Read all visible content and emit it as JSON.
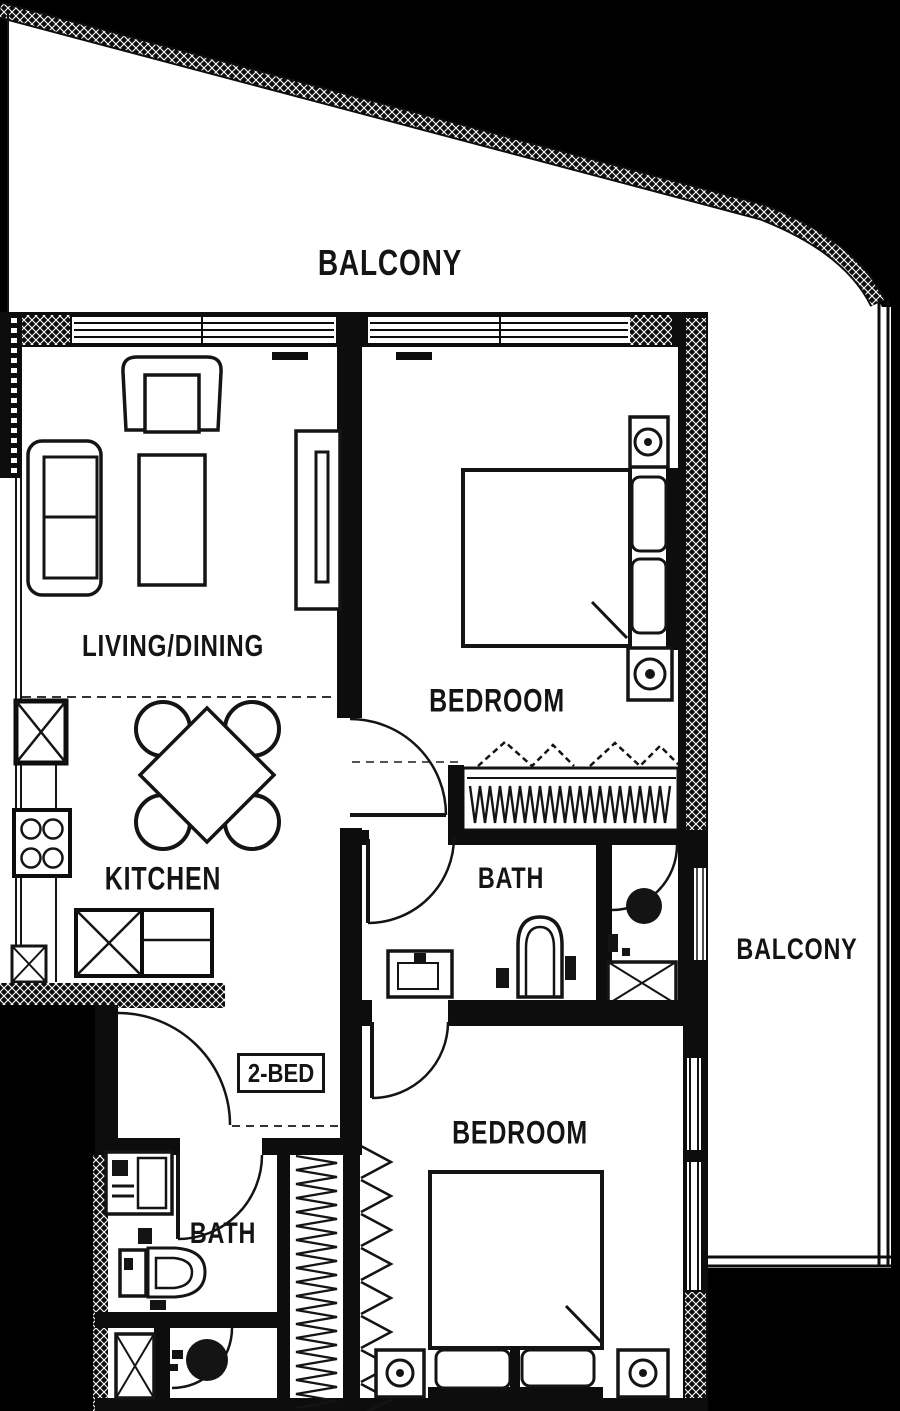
{
  "plan": {
    "unit_label": "2-BED",
    "labels": {
      "balcony_top": "BALCONY",
      "living_dining": "LIVING/DINING",
      "bedroom_top": "BEDROOM",
      "kitchen": "KITCHEN",
      "bath_middle": "BATH",
      "balcony_right": "BALCONY",
      "bath_bottom": "BATH",
      "bedroom_bottom": "BEDROOM"
    },
    "colors": {
      "background": "#000000",
      "floor": "#ffffff",
      "line": "#141414"
    }
  }
}
